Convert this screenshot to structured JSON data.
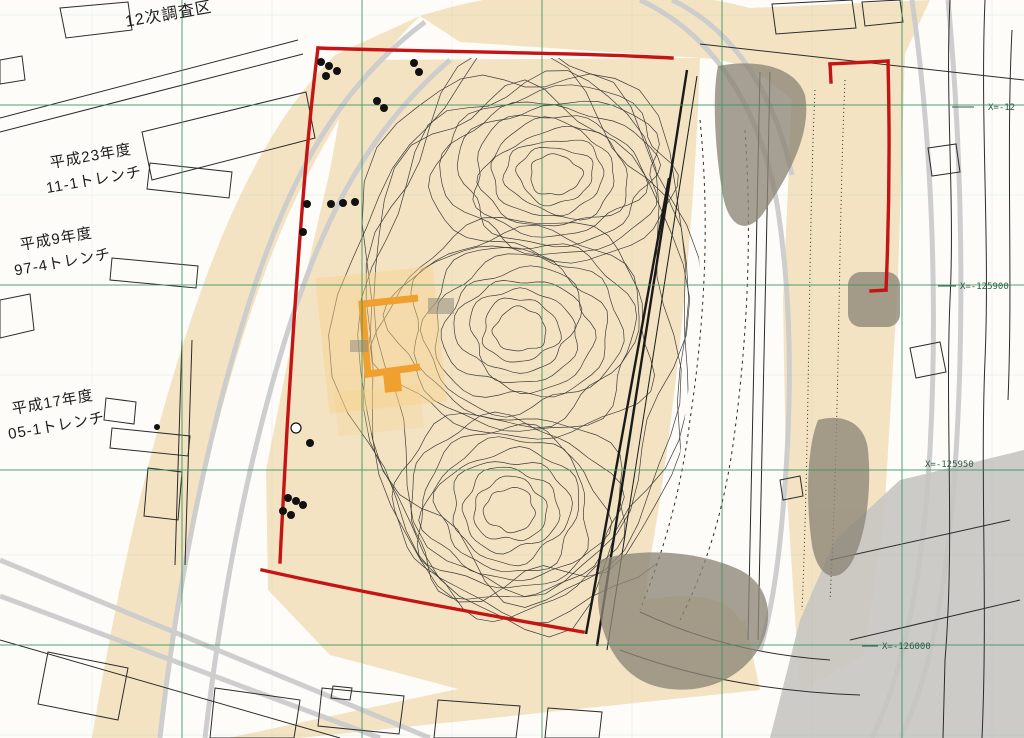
{
  "labels": {
    "survey_area": "12次調査区",
    "trench_h23_year": "平成23年度",
    "trench_h23_name": "11-1トレンチ",
    "trench_h9_year": "平成9年度",
    "trench_h9_name": "97-4トレンチ",
    "trench_h17_year": "平成17年度",
    "trench_h17_name": "05-1トレンチ"
  },
  "grid": {
    "x_line_1": "X=-12",
    "x_line_2": "X=-125900",
    "x_line_3": "X=-125950",
    "x_line_4": "X=-126000"
  },
  "colors": {
    "boundary-red": "#c41414",
    "site-beige": "#f3e3c3",
    "highlight-orange": "#efa02e",
    "highlight-orange-light": "#f6d08a",
    "grid-green": "#37925f",
    "shade-taupe": "#8d8577",
    "road-gray": "#cccccc",
    "ink": "#2b2b2b"
  }
}
